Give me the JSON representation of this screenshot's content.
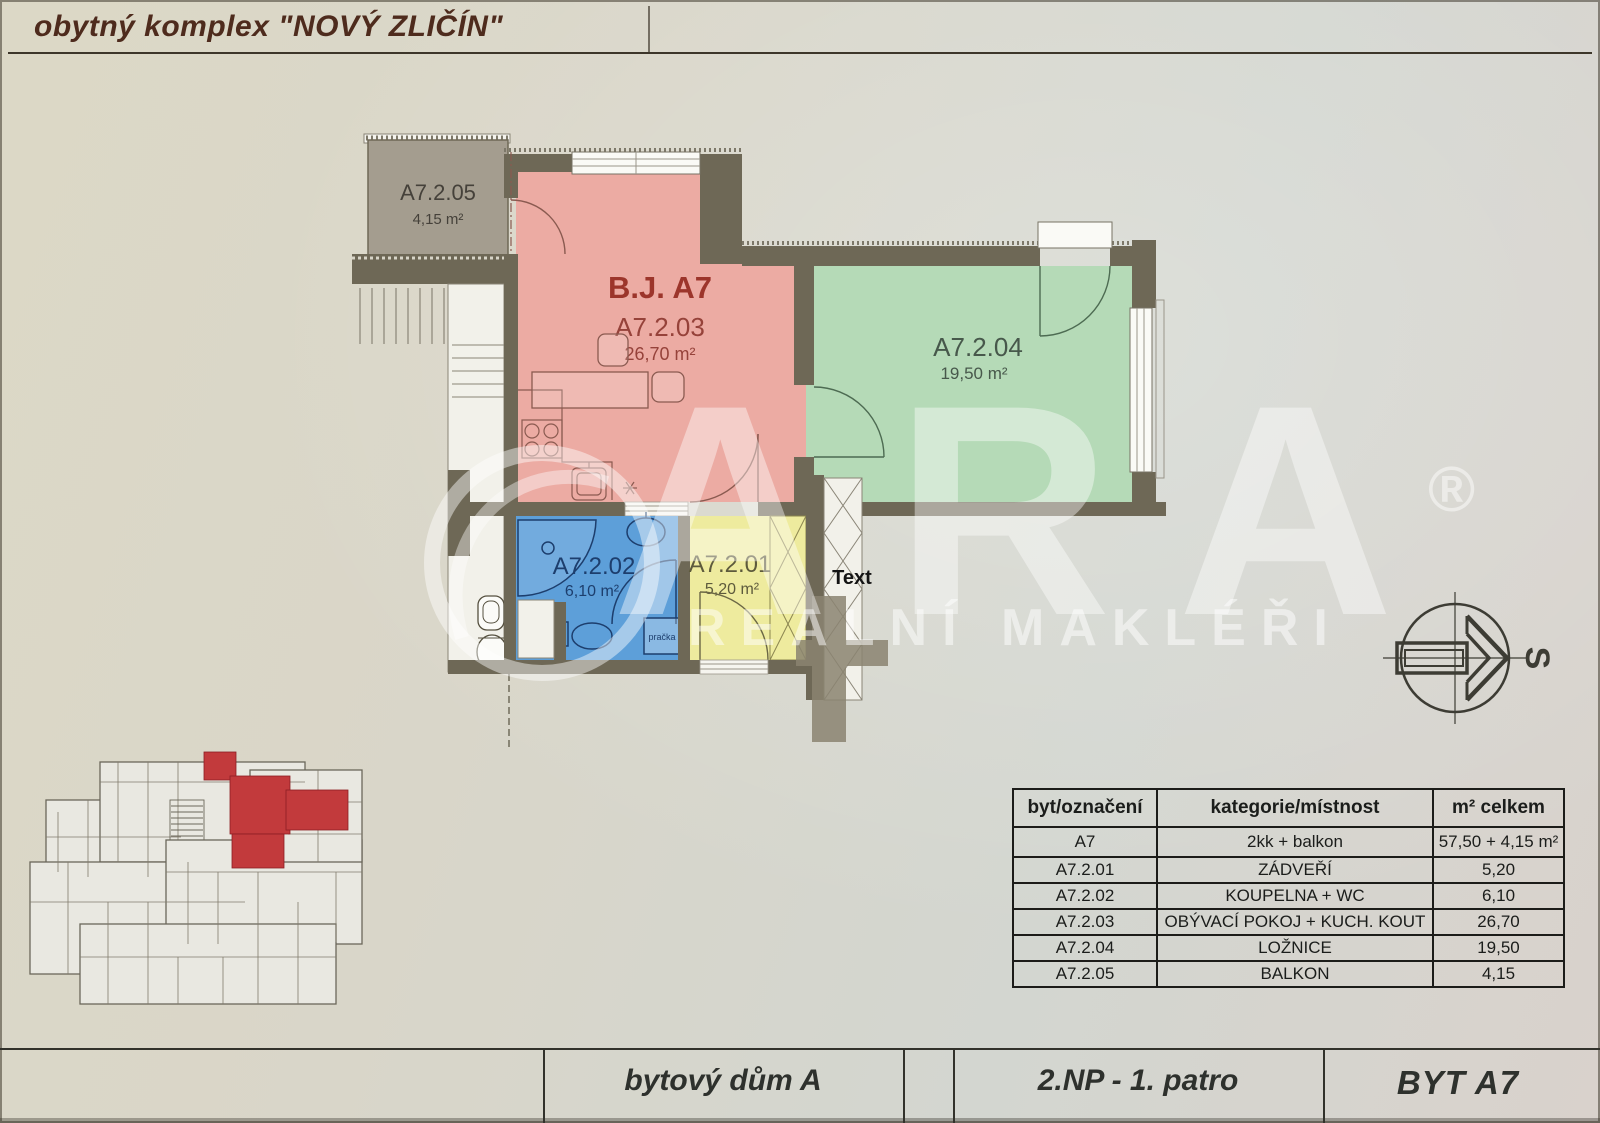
{
  "title": "obytný komplex \"NOVÝ ZLIČÍN\"",
  "plan": {
    "unit_label": "B.J. A7",
    "rooms": {
      "balkon": {
        "id": "A7.2.05",
        "area": "4,15 m²",
        "color": "#a49d8f"
      },
      "obyvaci": {
        "id": "A7.2.03",
        "area": "26,70 m²",
        "color": "#ecaba3"
      },
      "loznice": {
        "id": "A7.2.04",
        "area": "19,50 m²",
        "color": "#b5dab7"
      },
      "koupelna": {
        "id": "A7.2.02",
        "area": "6,10 m²",
        "color": "#5d9fd9"
      },
      "zadveri": {
        "id": "A7.2.01",
        "area": "5,20 m²",
        "color": "#eeeb9e"
      }
    },
    "annotations": {
      "text_label": "Text",
      "washer": "pračka",
      "compass_letter": "S"
    }
  },
  "watermark": {
    "brand": "ARA",
    "registered": "®",
    "tagline": "REALNÍ MAKLÉŘI"
  },
  "table": {
    "headers": [
      "byt/označení",
      "kategorie/místnost",
      "m² celkem"
    ],
    "rows": [
      [
        "A7",
        "2kk + balkon",
        "57,50 + 4,15 m²"
      ],
      [
        "A7.2.01",
        "ZÁDVEŘÍ",
        "5,20"
      ],
      [
        "A7.2.02",
        "KOUPELNA + WC",
        "6,10"
      ],
      [
        "A7.2.03",
        "OBÝVACÍ POKOJ + KUCH. KOUT",
        "26,70"
      ],
      [
        "A7.2.04",
        "LOŽNICE",
        "19,50"
      ],
      [
        "A7.2.05",
        "BALKON",
        "4,15"
      ]
    ]
  },
  "footer": {
    "building": "bytový dům A",
    "floor": "2.NP - 1. patro",
    "unit": "BYT A7"
  },
  "palette": {
    "wall": "#6e6856",
    "title_text": "#4e2b1d",
    "highlight_unit": "#c23a3c"
  }
}
